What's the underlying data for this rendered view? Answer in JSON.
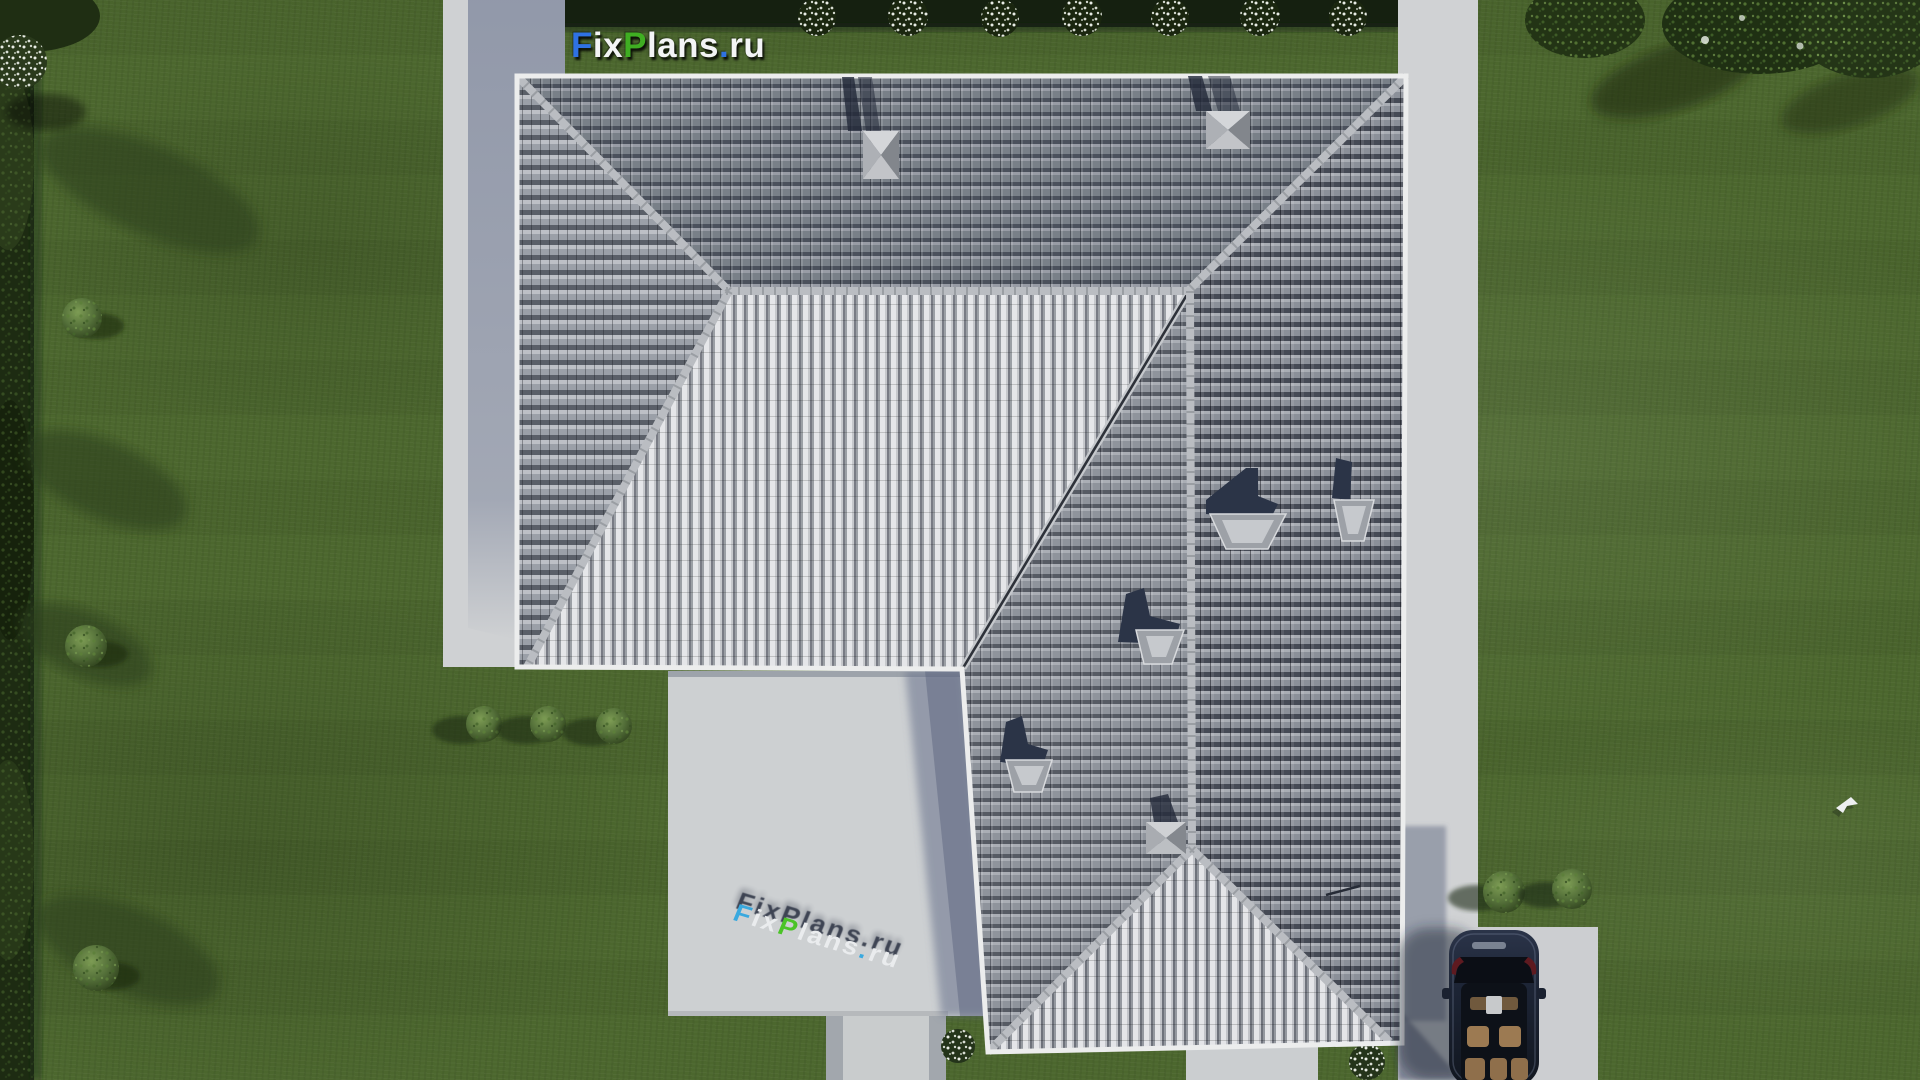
{
  "brand": {
    "name": "FixPlans.ru",
    "parts": [
      {
        "text": "F",
        "color": "#2f72e3"
      },
      {
        "text": "ix",
        "color": "#f3f4f5"
      },
      {
        "text": "P",
        "color": "#3fae22"
      },
      {
        "text": "lans",
        "color": "#f3f4f5"
      },
      {
        "text": ".",
        "color": "#2f72e3"
      },
      {
        "text": "ru",
        "color": "#f3f4f5"
      }
    ]
  },
  "watermark": {
    "name": "FixPlans.ru",
    "parts": [
      {
        "text": "F",
        "color": "#35a8e0"
      },
      {
        "text": "ix",
        "color": "#eceef0"
      },
      {
        "text": "P",
        "color": "#46c421"
      },
      {
        "text": "lans",
        "color": "#eceef0"
      },
      {
        "text": ".",
        "color": "#35a8e0"
      },
      {
        "text": "ru",
        "color": "#eceef0"
      }
    ]
  },
  "palette": {
    "grass": "#4c672e",
    "hedge_dark": "#152010",
    "concrete_light": "#cfd1d3",
    "paver_gray": "#a2a7ad",
    "roof_north": "#798088",
    "roof_row_shadow": "#4b515c",
    "roof_sunlit_tile": "#e4e5e8",
    "ridge_cap": "#babdc2",
    "cast_shadow": "#6e7890",
    "car_body": "#1d2536",
    "car_interior_tan": "#9c7a52",
    "logo_blue": "#2f72e3",
    "logo_green": "#3fae22",
    "logo_white": "#f3f4f5"
  },
  "scene": {
    "type": "aerial-top-down-3d-render",
    "objects": [
      "lawn",
      "top-hedge-with-flowering-bushes",
      "left-hedge",
      "tree-shadows",
      "hip-roof-house",
      "roof-skylights",
      "roof-hatch-chimneys",
      "west-walkway",
      "south-patio",
      "patio-walkway",
      "gable-walkway",
      "east-walkway",
      "driveway",
      "parked-car",
      "garden-bushes",
      "flower-bushes",
      "white-bird-sprite"
    ]
  }
}
